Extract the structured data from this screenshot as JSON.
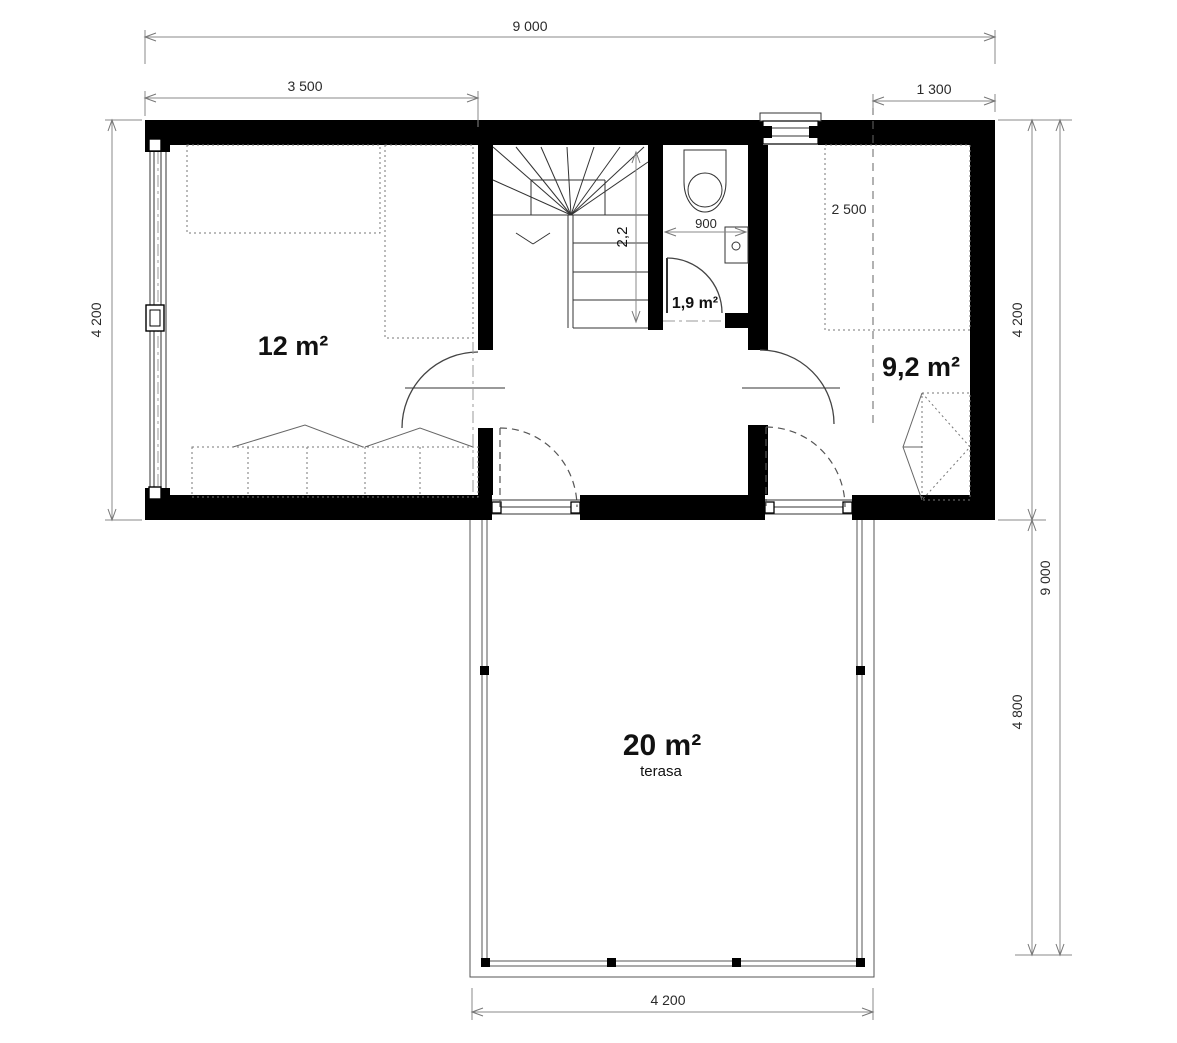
{
  "dimensions": {
    "overall_width": "9 000",
    "bedroom_left_width": "3 500",
    "window_offset": "1 300",
    "left_height": "4 200",
    "right_upper_height": "4 200",
    "overall_height": "9 000",
    "terrace_height": "4 800",
    "terrace_width": "4 200",
    "stair_length": "2,2",
    "wc_width": "900",
    "bed_length": "2 500"
  },
  "rooms": {
    "bedroom_left": {
      "label": "12 m²"
    },
    "wc": {
      "label": "1,9 m²"
    },
    "bedroom_right": {
      "label": "9,2 m²"
    },
    "terrace": {
      "label": "20 m²",
      "sublabel": "terasa"
    }
  }
}
